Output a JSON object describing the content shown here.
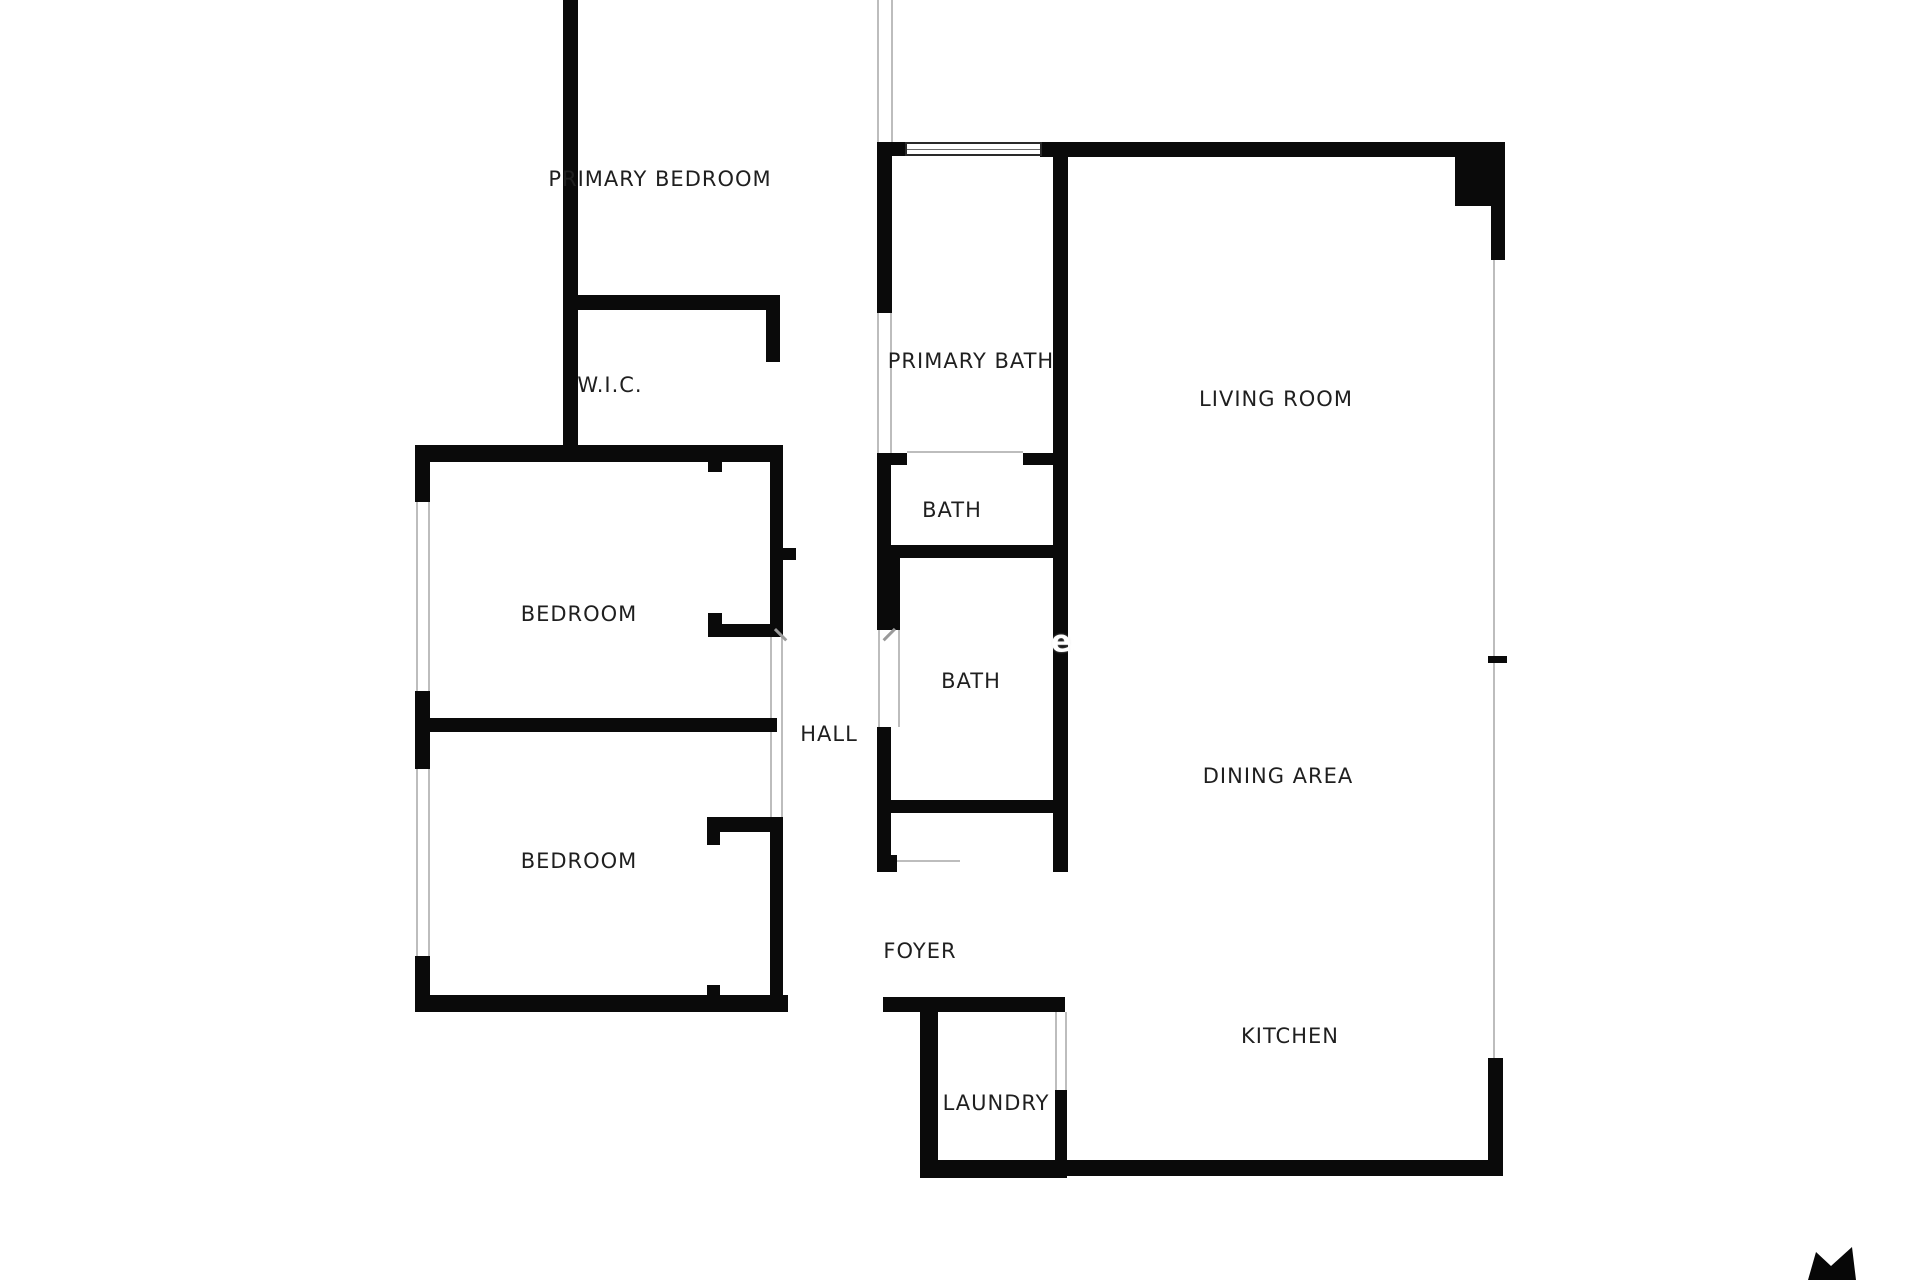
{
  "page": {
    "background": "#ffffff"
  },
  "floorplan": {
    "wall_color": "#0a0a0a",
    "thin_line_color": "#bdbdbd",
    "label_color": "#1f1f1f",
    "rooms": [
      {
        "id": "primary-bedroom",
        "label": "PRIMARY BEDROOM",
        "cx": 660,
        "cy": 179
      },
      {
        "id": "wic",
        "label": "W.I.C.",
        "cx": 610,
        "cy": 385
      },
      {
        "id": "primary-bath",
        "label": "PRIMARY BATH",
        "cx": 971,
        "cy": 361
      },
      {
        "id": "living-room",
        "label": "LIVING ROOM",
        "cx": 1276,
        "cy": 399
      },
      {
        "id": "bath-upper",
        "label": "BATH",
        "cx": 952,
        "cy": 510
      },
      {
        "id": "bedroom-1",
        "label": "BEDROOM",
        "cx": 579,
        "cy": 614
      },
      {
        "id": "bath-lower",
        "label": "BATH",
        "cx": 971,
        "cy": 681
      },
      {
        "id": "hall",
        "label": "HALL",
        "cx": 829,
        "cy": 734
      },
      {
        "id": "dining-area",
        "label": "DINING AREA",
        "cx": 1278,
        "cy": 776
      },
      {
        "id": "bedroom-2",
        "label": "BEDROOM",
        "cx": 579,
        "cy": 861
      },
      {
        "id": "foyer",
        "label": "FOYER",
        "cx": 920,
        "cy": 951
      },
      {
        "id": "kitchen",
        "label": "KITCHEN",
        "cx": 1290,
        "cy": 1036
      },
      {
        "id": "laundry",
        "label": "LAUNDRY",
        "cx": 996,
        "cy": 1103
      }
    ],
    "walls": [
      [
        563,
        0,
        15,
        455
      ],
      [
        563,
        295,
        217,
        15
      ],
      [
        766,
        295,
        14,
        67
      ],
      [
        415,
        445,
        368,
        17
      ],
      [
        415,
        445,
        15,
        57
      ],
      [
        415,
        691,
        15,
        78
      ],
      [
        415,
        956,
        15,
        56
      ],
      [
        430,
        718,
        347,
        14
      ],
      [
        415,
        995,
        373,
        17
      ],
      [
        708,
        462,
        14,
        10
      ],
      [
        770,
        448,
        13,
        189
      ],
      [
        783,
        548,
        13,
        12
      ],
      [
        708,
        613,
        14,
        24
      ],
      [
        708,
        624,
        75,
        13
      ],
      [
        707,
        817,
        76,
        15
      ],
      [
        707,
        817,
        13,
        28
      ],
      [
        770,
        817,
        13,
        195
      ],
      [
        707,
        985,
        13,
        27
      ],
      [
        877,
        142,
        15,
        171
      ],
      [
        877,
        142,
        30,
        14
      ],
      [
        1040,
        142,
        465,
        15
      ],
      [
        1455,
        142,
        50,
        64
      ],
      [
        1491,
        206,
        14,
        54
      ],
      [
        877,
        453,
        30,
        12
      ],
      [
        1023,
        453,
        32,
        12
      ],
      [
        877,
        453,
        14,
        95
      ],
      [
        877,
        545,
        191,
        13
      ],
      [
        877,
        548,
        23,
        82
      ],
      [
        877,
        727,
        14,
        145
      ],
      [
        877,
        855,
        20,
        17
      ],
      [
        877,
        800,
        191,
        13
      ],
      [
        1053,
        155,
        15,
        717
      ],
      [
        883,
        997,
        182,
        15
      ],
      [
        920,
        997,
        18,
        181
      ],
      [
        920,
        1160,
        147,
        18
      ],
      [
        1055,
        1090,
        12,
        88
      ],
      [
        1067,
        1160,
        436,
        16
      ],
      [
        1488,
        1058,
        15,
        118
      ],
      [
        1488,
        656,
        19,
        7
      ]
    ],
    "thin_lines": [
      [
        877,
        0,
        2,
        142
      ],
      [
        891,
        0,
        2,
        142
      ],
      [
        416,
        502,
        2,
        189
      ],
      [
        428,
        502,
        2,
        189
      ],
      [
        416,
        769,
        2,
        187
      ],
      [
        428,
        769,
        2,
        187
      ],
      [
        770,
        637,
        2,
        180
      ],
      [
        781,
        637,
        2,
        180
      ],
      [
        877,
        313,
        2,
        140
      ],
      [
        890,
        313,
        2,
        140
      ],
      [
        878,
        630,
        2,
        97
      ],
      [
        898,
        630,
        2,
        97
      ],
      [
        907,
        451,
        116,
        2
      ],
      [
        897,
        860,
        63,
        2
      ],
      [
        1493,
        258,
        2,
        399
      ],
      [
        1493,
        663,
        2,
        395
      ],
      [
        1055,
        1012,
        2,
        78
      ],
      [
        1065,
        1012,
        2,
        78
      ]
    ],
    "door_marks": [
      {
        "x": 776,
        "y": 628,
        "len": 16,
        "angle": 45
      },
      {
        "x": 896,
        "y": 630,
        "len": 16,
        "angle": 135
      }
    ],
    "window": {
      "x": 905,
      "y": 142,
      "w": 137,
      "h": 14
    },
    "watermark": {
      "text": "e",
      "cx": 1061,
      "cy": 642
    },
    "logo": {
      "x": 1800,
      "y": 1245,
      "w": 60,
      "h": 35,
      "points": "8,35 16,7 31,21 52,2 56,35",
      "color": "#070707"
    }
  }
}
